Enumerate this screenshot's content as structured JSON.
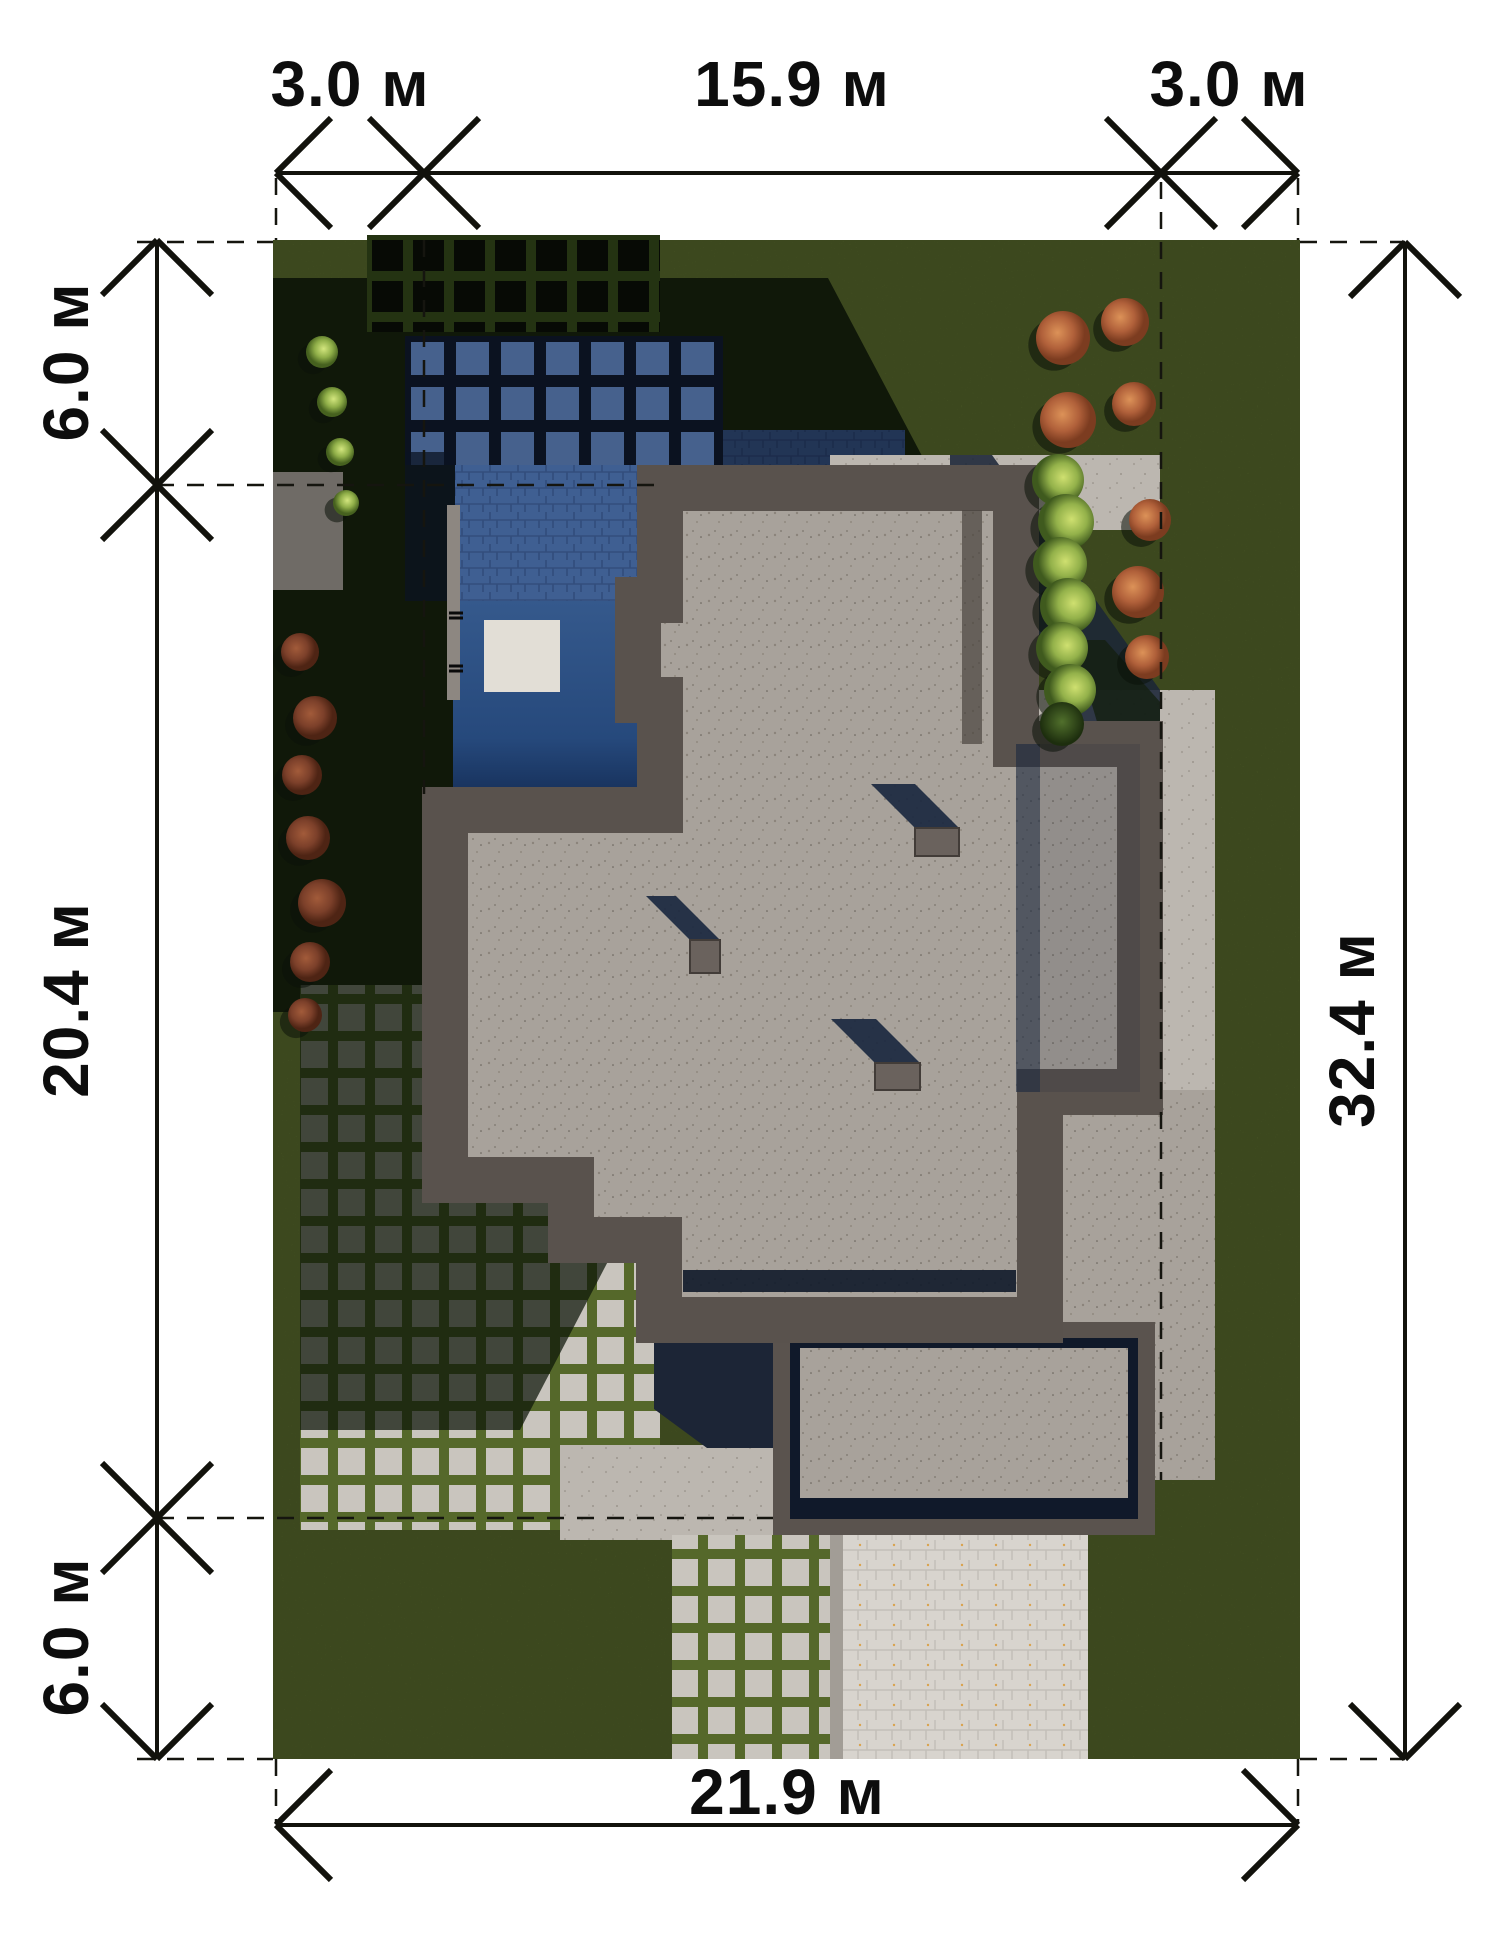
{
  "plan": {
    "type": "site-plan",
    "units": "м",
    "dimensions": {
      "top": {
        "left_setback": "3.0 м",
        "building_width": "15.9 м",
        "right_setback": "3.0 м"
      },
      "left": {
        "front_setback": "6.0 м",
        "building_depth": "20.4 м",
        "back_setback": "6.0 м"
      },
      "right": {
        "lot_depth": "32.4 м"
      },
      "bottom": {
        "lot_width": "21.9 м"
      }
    },
    "colors": {
      "grass": "#57682c",
      "grass_shadow": "#0d1408",
      "roof_concrete": "#a8a29b",
      "parapet": "#59524d",
      "pool_water": "#2f5587",
      "pool_deck_tiles": "#3f5f92",
      "shadow_navy": "#1b2433",
      "paving_light": "#b6b1aa",
      "driveway": "#d6d2cc",
      "paver_joint_green": "#4b5d22",
      "dimension_ink": "#12120c"
    },
    "scene": {
      "trees": [
        {
          "kind": "orange",
          "x": 1063,
          "y": 338,
          "r": 27
        },
        {
          "kind": "orange",
          "x": 1125,
          "y": 322,
          "r": 24
        },
        {
          "kind": "orange",
          "x": 1068,
          "y": 420,
          "r": 28
        },
        {
          "kind": "orange",
          "x": 1134,
          "y": 404,
          "r": 22
        },
        {
          "kind": "orange",
          "x": 1150,
          "y": 520,
          "r": 21
        },
        {
          "kind": "orange",
          "x": 1138,
          "y": 592,
          "r": 26
        },
        {
          "kind": "orange",
          "x": 1147,
          "y": 657,
          "r": 22
        },
        {
          "kind": "hedge",
          "x": 1058,
          "y": 480,
          "r": 26
        },
        {
          "kind": "hedge",
          "x": 1066,
          "y": 522,
          "r": 28
        },
        {
          "kind": "hedge",
          "x": 1060,
          "y": 564,
          "r": 27
        },
        {
          "kind": "hedge",
          "x": 1068,
          "y": 606,
          "r": 28
        },
        {
          "kind": "hedge",
          "x": 1062,
          "y": 648,
          "r": 26
        },
        {
          "kind": "hedge",
          "x": 1070,
          "y": 690,
          "r": 26
        },
        {
          "kind": "hedgedark",
          "x": 1062,
          "y": 724,
          "r": 22
        },
        {
          "kind": "bush",
          "x": 322,
          "y": 352,
          "r": 16
        },
        {
          "kind": "bush",
          "x": 332,
          "y": 402,
          "r": 15
        },
        {
          "kind": "bush",
          "x": 340,
          "y": 452,
          "r": 14
        },
        {
          "kind": "bush",
          "x": 346,
          "y": 503,
          "r": 13
        },
        {
          "kind": "red",
          "x": 300,
          "y": 652,
          "r": 19
        },
        {
          "kind": "red",
          "x": 315,
          "y": 718,
          "r": 22
        },
        {
          "kind": "red",
          "x": 302,
          "y": 775,
          "r": 20
        },
        {
          "kind": "red",
          "x": 308,
          "y": 838,
          "r": 22
        },
        {
          "kind": "red",
          "x": 322,
          "y": 903,
          "r": 24
        },
        {
          "kind": "red",
          "x": 310,
          "y": 962,
          "r": 20
        },
        {
          "kind": "red",
          "x": 305,
          "y": 1015,
          "r": 17
        }
      ],
      "roof_boxes": [
        {
          "x": 915,
          "y": 828,
          "w": 44,
          "h": 28
        },
        {
          "x": 690,
          "y": 940,
          "w": 30,
          "h": 33
        },
        {
          "x": 875,
          "y": 1063,
          "w": 45,
          "h": 27
        }
      ]
    }
  }
}
